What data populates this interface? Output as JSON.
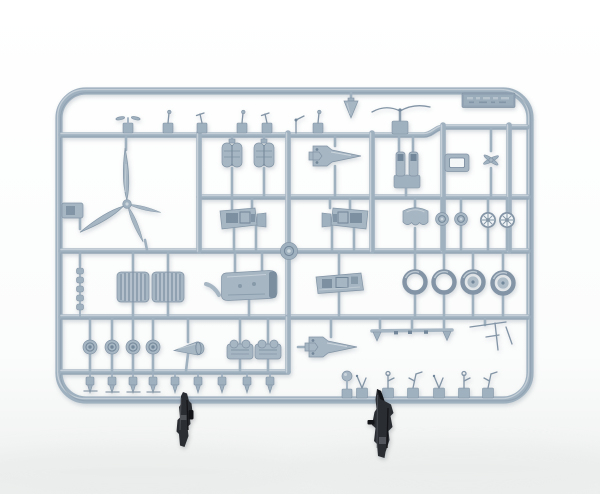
{
  "image": {
    "type": "photograph",
    "subject": "injection-molded plastic model kit sprue with aircraft parts",
    "aria_label": "Photograph of a light grey plastic model-kit sprue holding many small aircraft parts, with two dark grey parts standing upright in front of its bottom edge",
    "background": "plain white studio background"
  },
  "colors": {
    "background_top": "#ffffff",
    "background_bottom": "#edefee",
    "sprue_base": "#9fb0bf",
    "sprue_part": "#a7b6c3",
    "sprue_shadow": "#8294a5",
    "sprue_highlight": "#cbd5dc",
    "sprue_deep": "#72879a",
    "dark_part": "#2a2d32",
    "dark_part_deep": "#131417",
    "dark_part_highlight": "#5c6066"
  },
  "sprue": {
    "plastic_color_name": "light blue-grey",
    "frame_shape": "rounded rectangle",
    "label_plate": {
      "present": true,
      "embossed_text_legible": false
    }
  },
  "parts_inventory": [
    {
      "name": "four-blade-propeller",
      "count": 1
    },
    {
      "name": "engine-cylinder-bank",
      "count": 2
    },
    {
      "name": "engine-mount-bracket",
      "count": 2
    },
    {
      "name": "cockpit-sidewall-panel",
      "count": 2
    },
    {
      "name": "fuselage-deck",
      "count": 1
    },
    {
      "name": "cockpit-floor",
      "count": 1
    },
    {
      "name": "radiator-core",
      "count": 2
    },
    {
      "name": "main-wheel-tire",
      "count": 4
    },
    {
      "name": "wheel-hub-cover",
      "count": 4
    },
    {
      "name": "wheel-hub-face",
      "count": 2
    },
    {
      "name": "spoked-wheel-hub",
      "count": 2
    },
    {
      "name": "engine-cowling-front",
      "count": 1
    },
    {
      "name": "windscreen-frame",
      "count": 1
    },
    {
      "name": "exhaust-stub-rail",
      "count": 1
    },
    {
      "name": "spinner-cone",
      "count": 1
    },
    {
      "name": "gear-bay-insert",
      "count": 2
    },
    {
      "name": "small-detail-part",
      "count": "many"
    },
    {
      "name": "dark-standing-part",
      "count": 2
    }
  ]
}
